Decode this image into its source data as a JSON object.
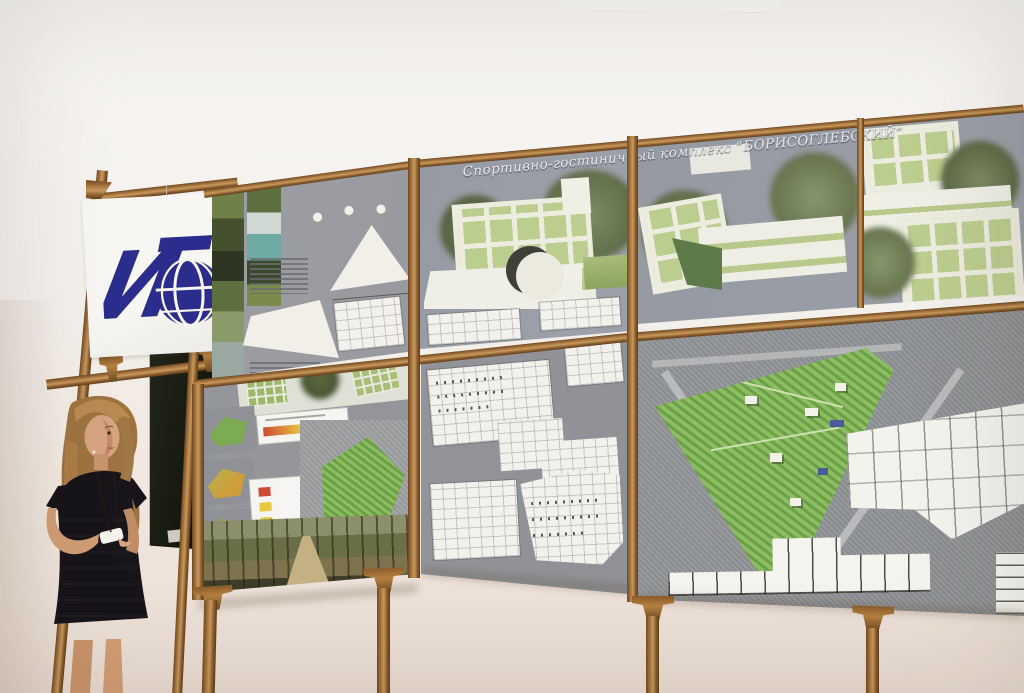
{
  "scene": {
    "board_title": "Спортивно-гостиничный комплекс “БОРИСОГЛЕБСКИЙ”",
    "banner_logo": {
      "letters": "ИГ",
      "icon": "globe-icon",
      "color": "#2b2d8c"
    },
    "legend_colors": {
      "low": "#cf4937",
      "mid": "#e7c83e",
      "high": "#6fbf4a"
    },
    "palette": {
      "wall": "#f3efeb",
      "wood_frame": "#9c6b39",
      "board_gray": "#97989e",
      "logo_blue": "#2b2d8c",
      "site_green": "#7fb257",
      "glass_green": "#c2d096",
      "city_blue": "#5a6aa5",
      "chalkboard": "#1a1c12"
    }
  }
}
